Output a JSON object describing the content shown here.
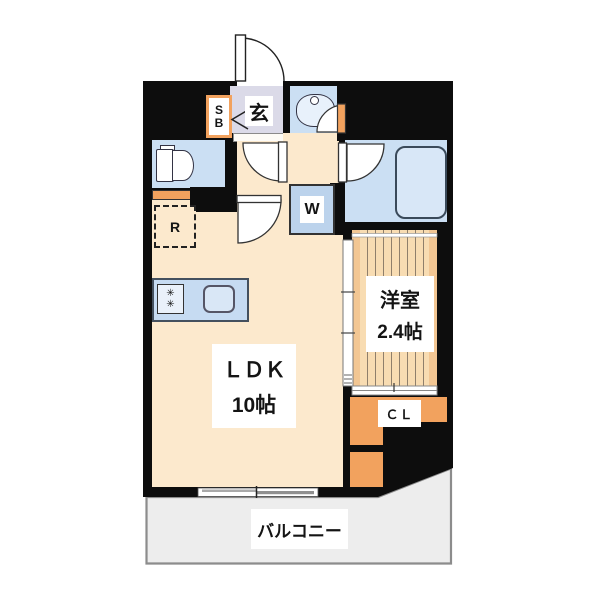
{
  "plan_type": "apartment floor plan",
  "labels": {
    "entrance": "玄",
    "shoe_box_line1": "S",
    "shoe_box_line2": "B",
    "refrigerator": "R",
    "washer": "W",
    "ldk_name": "ＬＤＫ",
    "ldk_size": "10帖",
    "western_room_name": "洋室",
    "western_room_size": "2.4帖",
    "closet": "ＣＬ",
    "balcony": "バルコニー"
  },
  "icons": {
    "stove_burner": "✳"
  },
  "colors": {
    "wall_black": "#0d0d0d",
    "floor_cream": "#fce9cd",
    "water_blue": "#cbdff3",
    "wood_tan": "#f8dcb2",
    "accent_orange": "#f2a25e",
    "entrance_lavender": "#dbdae8",
    "balcony_gray": "#ededed"
  }
}
